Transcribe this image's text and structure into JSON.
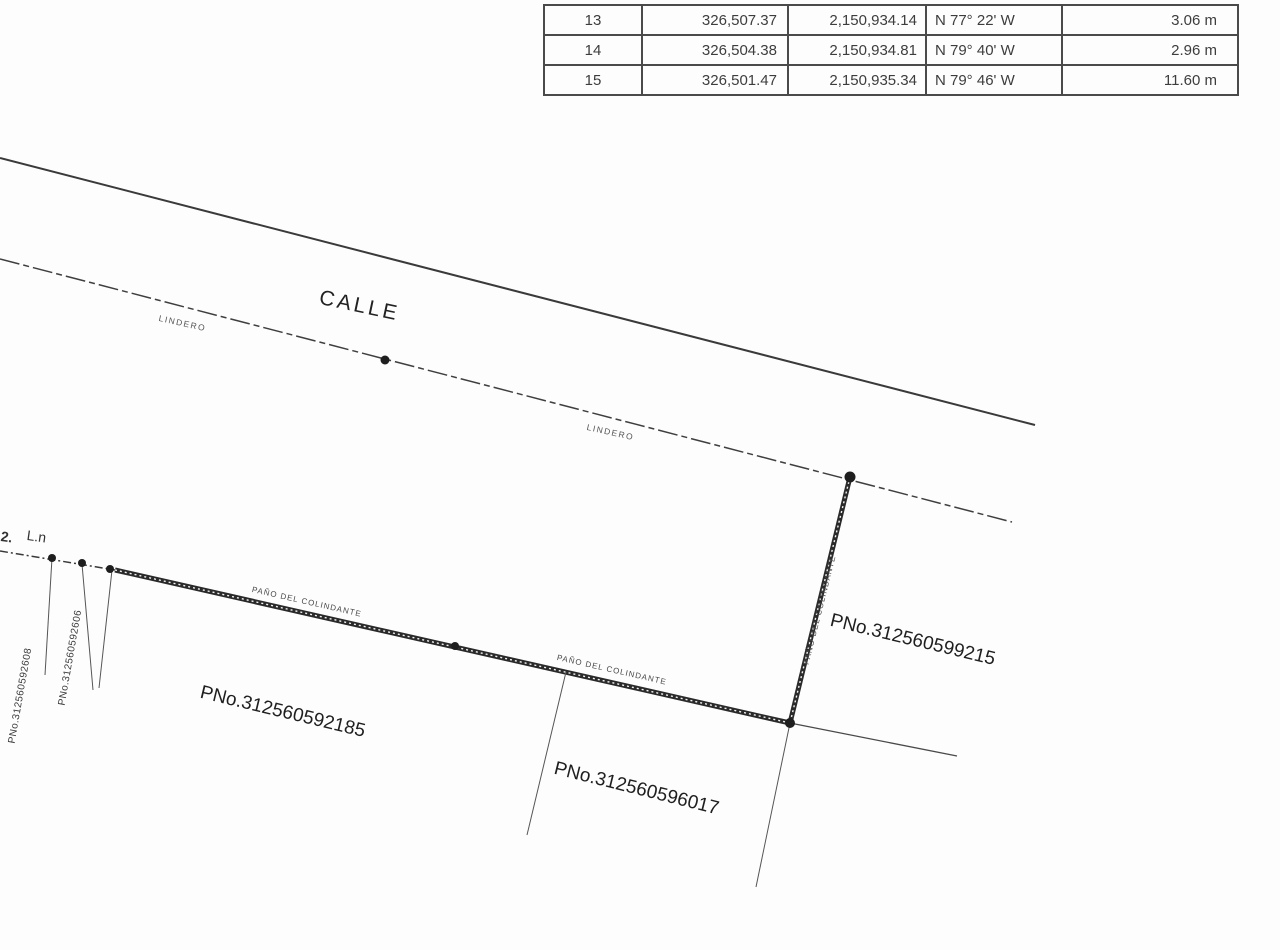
{
  "ink_color": "#2b2b2b",
  "table": {
    "rows": [
      {
        "no": "13",
        "x": "326,507.37",
        "y": "2,150,934.14",
        "bearing": "N 77° 22' W",
        "distance": "3.06 m"
      },
      {
        "no": "14",
        "x": "326,504.38",
        "y": "2,150,934.81",
        "bearing": "N 79° 40' W",
        "distance": "2.96 m"
      },
      {
        "no": "15",
        "x": "326,501.47",
        "y": "2,150,935.34",
        "bearing": "N 79° 46' W",
        "distance": "11.60 m"
      }
    ]
  },
  "drawing": {
    "street_label": "CALLE",
    "lindero_label_1": "LINDERO",
    "lindero_label_2": "LINDERO",
    "boundary_label_1": "PAÑO DEL COLINDANTE",
    "boundary_label_2": "PAÑO DEL COLINDANTE",
    "boundary_label_vertical": "PAÑO DEL COLINDANTE",
    "parcel_right": "PNo.312560599215",
    "parcel_left": "PNo.312560592185",
    "parcel_bottom": "PNo.312560596017",
    "parcel_side_1": "PNo.312560592608",
    "parcel_side_2": "PNo.312560592606",
    "corner_note_1": "2.",
    "corner_note_2": "L.n"
  }
}
